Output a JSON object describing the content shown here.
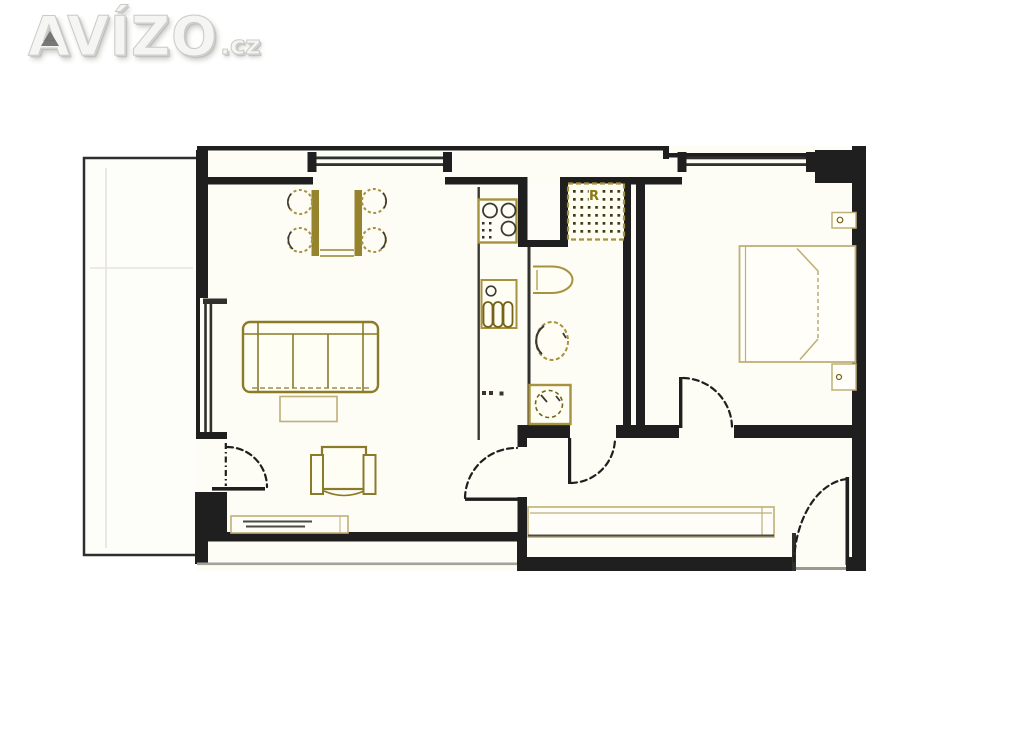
{
  "logo": {
    "brand": "AVÍZO",
    "tld": ".cz",
    "style": "embossed-white-wordmark"
  },
  "floor_plan": {
    "kind": "apartment floor plan drawing",
    "washer_label": "R",
    "rooms": [
      {
        "name": "living-room",
        "furniture": [
          "dining-table",
          "chair",
          "chair",
          "chair",
          "chair",
          "sofa",
          "coffee-table",
          "armchair",
          "sideboard"
        ]
      },
      {
        "name": "kitchen-strip",
        "furniture": [
          "stove-cooktop",
          "sink-unit",
          "counter"
        ]
      },
      {
        "name": "bathroom",
        "furniture": [
          "washing-machine",
          "wash-basin",
          "toilet",
          "shower"
        ]
      },
      {
        "name": "bedroom",
        "furniture": [
          "double-bed",
          "nightstand",
          "nightstand"
        ]
      },
      {
        "name": "hallway",
        "furniture": [
          "wardrobe"
        ]
      },
      {
        "name": "balcony",
        "furniture": []
      }
    ],
    "doors": [
      "balcony-door",
      "living-room-door",
      "bathroom-door",
      "bedroom-door",
      "entry-door"
    ],
    "windows": [
      "living-room-window",
      "bedroom-window"
    ]
  },
  "colors": {
    "wall": "#1f1f1f",
    "wall-thin": "#30302c",
    "furn": "#a6923f",
    "furn-dark": "#756317",
    "furn-light": "#bfb078",
    "dot": "#3e3913",
    "ink": "#3c3832",
    "room-fill": "#fdfcf5",
    "logo-fill": "#f5f5f3",
    "logo-edge": "#cacac6"
  }
}
